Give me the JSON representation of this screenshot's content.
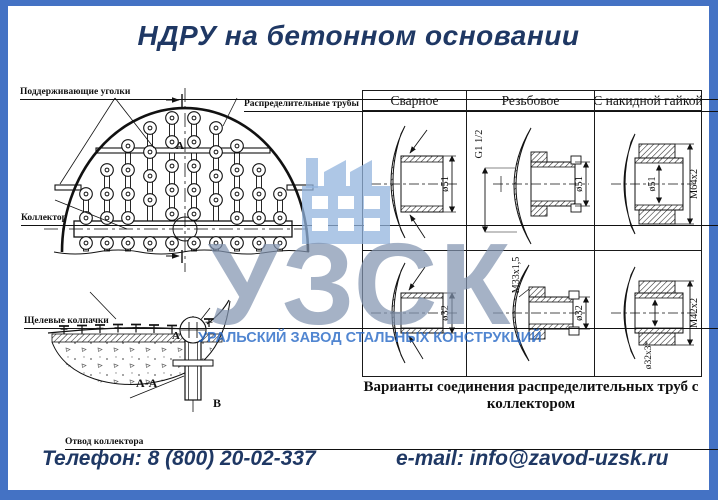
{
  "title": "НДРУ на бетонном основании",
  "diagram": {
    "labels": {
      "supporting_angles": "Поддерживающие уголки",
      "distribution_pipes": "Распределительные трубы",
      "collector": "Коллектор",
      "slotted_caps": "Щелевые колпачки",
      "collector_outlet": "Отвод коллектора"
    },
    "section_mark_top": "А",
    "section_mark_bottom": "А",
    "section_title": "А-А",
    "detail_mark": "В"
  },
  "connections_table": {
    "headers": [
      "Сварное",
      "Резьбовое",
      "С накидной гайкой"
    ],
    "rows": [
      {
        "welded": "ø51",
        "threaded_thread": "G1 1/2",
        "threaded_dia": "ø51",
        "union_thread": "M64x2",
        "union_dia": "ø51"
      },
      {
        "welded": "ø32",
        "threaded_thread": "M33x1,5",
        "threaded_dia": "ø32",
        "union_thread": "M42x2",
        "union_dia": "ø32x3*"
      }
    ],
    "caption": "Варианты соединения распределительных труб с коллектором"
  },
  "watermark": {
    "logo": "УЗСК",
    "subtitle": "УРАЛЬСКИЙ ЗАВОД СТАЛЬНЫХ КОНСТРУКЦИЙ"
  },
  "contacts": {
    "phone": "Телефон: 8 (800) 20-02-337",
    "email": "e-mail: info@zavod-uzsk.ru"
  },
  "colors": {
    "frame": "#4472c4",
    "heading": "#1f3864",
    "watermark_logo": "#8294b0",
    "watermark_subtitle": "#2668c5"
  }
}
